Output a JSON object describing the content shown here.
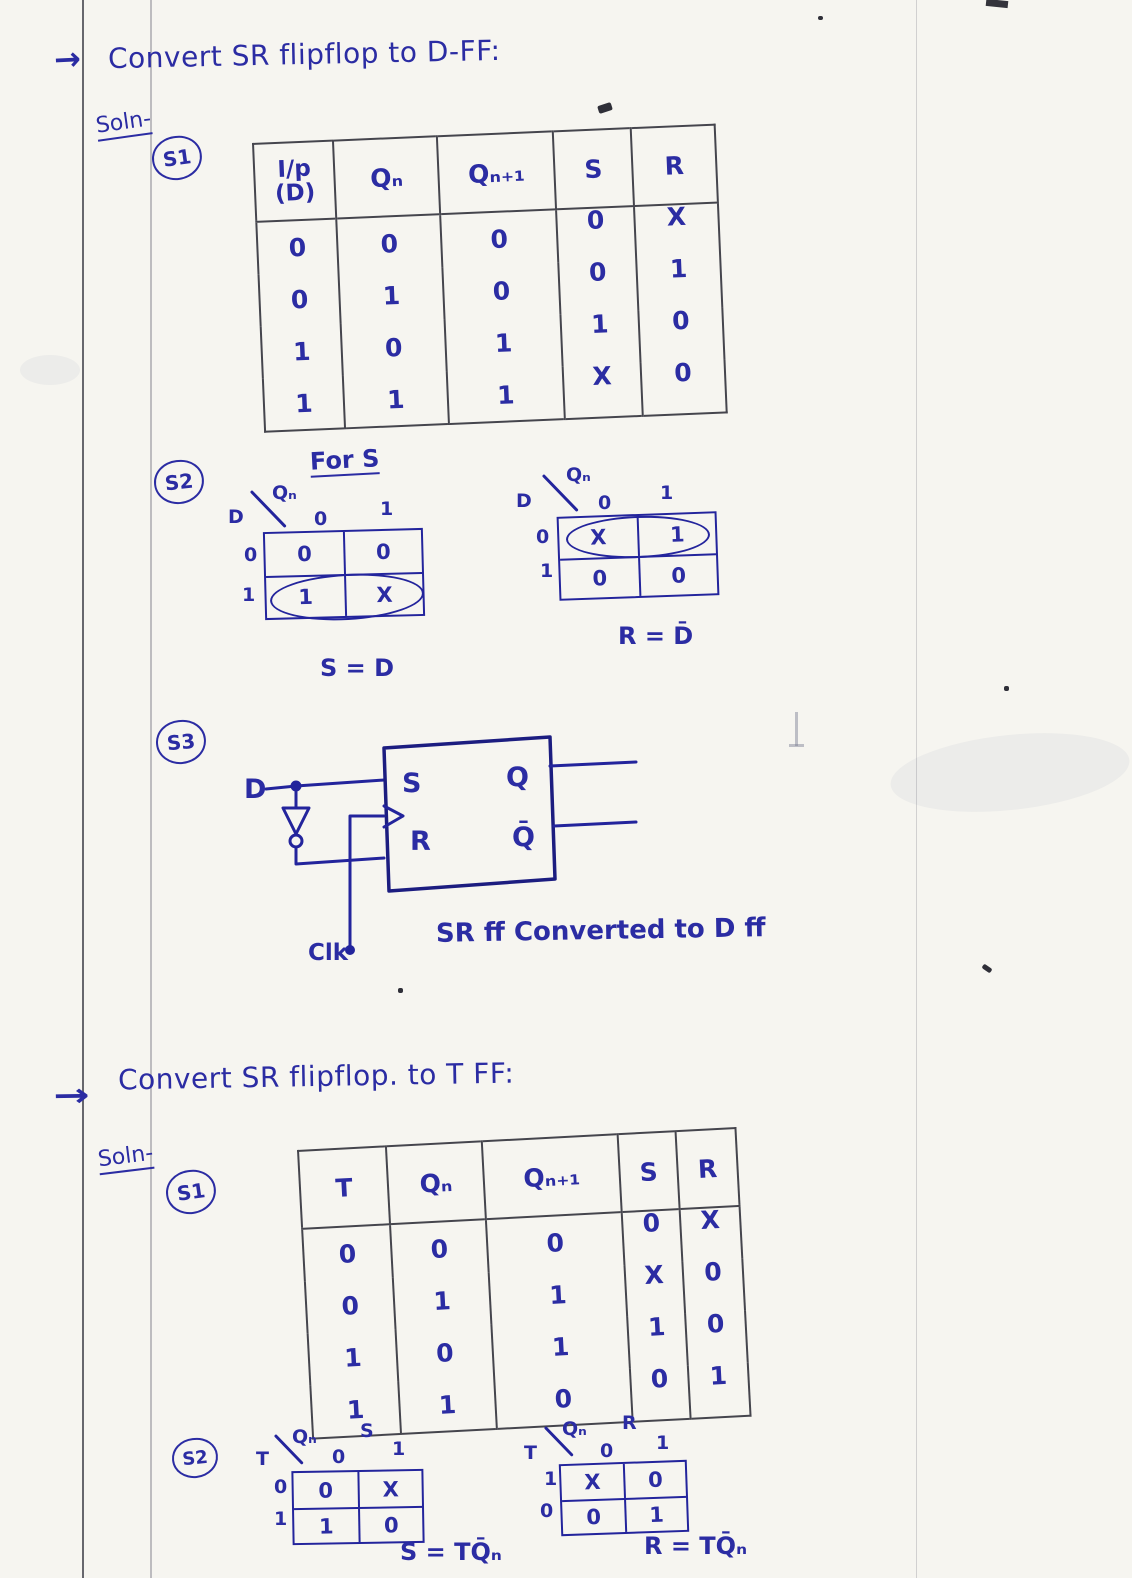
{
  "d_ff": {
    "arrow": "→",
    "title": "Convert SR flipflop to D-FF:",
    "soln": "Soln-",
    "s1": "S1",
    "table": {
      "headers": {
        "input_top": "I/p",
        "input_bottom": "(D)",
        "qn": "Qₙ",
        "qn1": "Qₙ₊₁",
        "s": "S",
        "r": "R"
      },
      "rows": [
        [
          "0",
          "0",
          "0",
          "0",
          "X"
        ],
        [
          "0",
          "1",
          "0",
          "0",
          "1"
        ],
        [
          "1",
          "0",
          "1",
          "1",
          "0"
        ],
        [
          "1",
          "1",
          "1",
          "X",
          "0"
        ]
      ]
    },
    "s2": "S2",
    "for_s": "For S",
    "kmap_s": {
      "rowvar": "D",
      "colvar": "Qₙ",
      "col0": "0",
      "col1": "1",
      "row0": "0",
      "row1": "1",
      "cells": [
        [
          "0",
          "0"
        ],
        [
          "1",
          "X"
        ]
      ],
      "result": "S = D"
    },
    "kmap_r": {
      "rowvar": "D",
      "colvar": "Qₙ",
      "col0": "0",
      "col1": "1",
      "row0": "0",
      "row1": "1",
      "cells": [
        [
          "X",
          "1"
        ],
        [
          "0",
          "0"
        ]
      ],
      "result": "R = D̄"
    },
    "s3": "S3",
    "circuit": {
      "d_label": "D",
      "s_label": "S",
      "r_label": "R",
      "q_label": "Q",
      "qbar_label": "Q̄",
      "clk_label": "Clk",
      "caption": "SR ff Converted to D ff"
    }
  },
  "t_ff": {
    "arrow": "→",
    "title": "Convert SR flipflop. to T FF:",
    "soln": "Soln-",
    "s1": "S1",
    "table": {
      "headers": {
        "t": "T",
        "qn": "Qₙ",
        "qn1": "Qₙ₊₁",
        "s": "S",
        "r": "R"
      },
      "rows": [
        [
          "0",
          "0",
          "0",
          "0",
          "X"
        ],
        [
          "0",
          "1",
          "1",
          "X",
          "0"
        ],
        [
          "1",
          "0",
          "1",
          "1",
          "0"
        ],
        [
          "1",
          "1",
          "0",
          "0",
          "1"
        ]
      ]
    },
    "s2": "S2",
    "kmap_s_title": "S",
    "kmap_r_title": "R",
    "kmap_s": {
      "rowvar": "T",
      "colvar": "Qₙ",
      "col0": "0",
      "col1": "1",
      "row0": "0",
      "row1": "1",
      "cells": [
        [
          "0",
          "X"
        ],
        [
          "1",
          "0"
        ]
      ],
      "result": "S = TQ̄ₙ"
    },
    "kmap_r": {
      "rowvar": "T",
      "colvar": "Qₙ",
      "col0": "0",
      "col1": "1",
      "row0": "1",
      "row1": "0",
      "cells": [
        [
          "X",
          "0"
        ],
        [
          "0",
          "1"
        ]
      ],
      "result": "R = TQ̄ₙ"
    }
  }
}
